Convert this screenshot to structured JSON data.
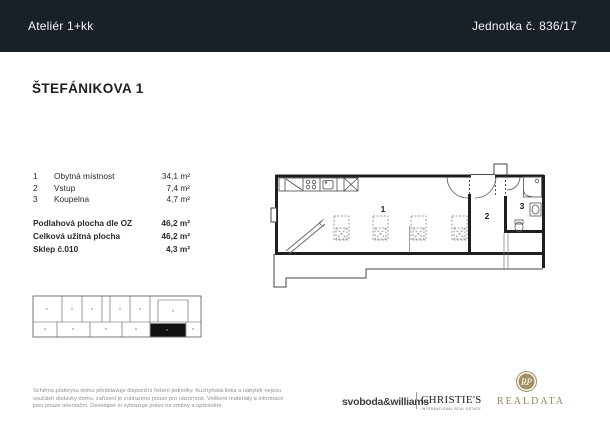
{
  "header": {
    "unit_type": "Ateliér 1+kk",
    "unit_number": "Jednotka č. 836/17"
  },
  "title": "ŠTEFÁNIKOVA 1",
  "legend": {
    "rooms": [
      {
        "num": "1",
        "name": "Obytná místnost",
        "area": "34,1 m²"
      },
      {
        "num": "2",
        "name": "Vstup",
        "area": "7,4 m²"
      },
      {
        "num": "3",
        "name": "Koupelna",
        "area": "4,7 m²"
      }
    ],
    "totals": [
      {
        "label": "Podlahová plocha dle OZ",
        "value": "46,2 m²"
      },
      {
        "label": "Celková užitná plocha",
        "value": "46,2 m²"
      },
      {
        "label": "Sklep č.010",
        "value": "4,3 m²"
      }
    ]
  },
  "floorplan": {
    "labels": {
      "room1": "1",
      "room2": "2",
      "room3": "3"
    }
  },
  "footer": {
    "disclaimer_lines": [
      "Schéma půdorysu domu představuje dispoziční řešení jednotky. Kuchyňská linka a nábytek nejsou",
      "součástí dodávky domu, zařízení je zobrazeno pouze pro názornost. Veškeré materiály a informace",
      "jsou pouze orientační. Developer si vyhrazuje právo na změny a upřesnění."
    ],
    "brands": {
      "svoboda": "svoboda&williams",
      "christies": "CHRISTIE'S",
      "christies_sub": "INTERNATIONAL REAL ESTATE",
      "realdata": "REALDATA",
      "monogram": "RP"
    }
  },
  "colors": {
    "header_bg": "#1a2028",
    "gold": "#a39062",
    "highlight_unit": "#111111"
  }
}
